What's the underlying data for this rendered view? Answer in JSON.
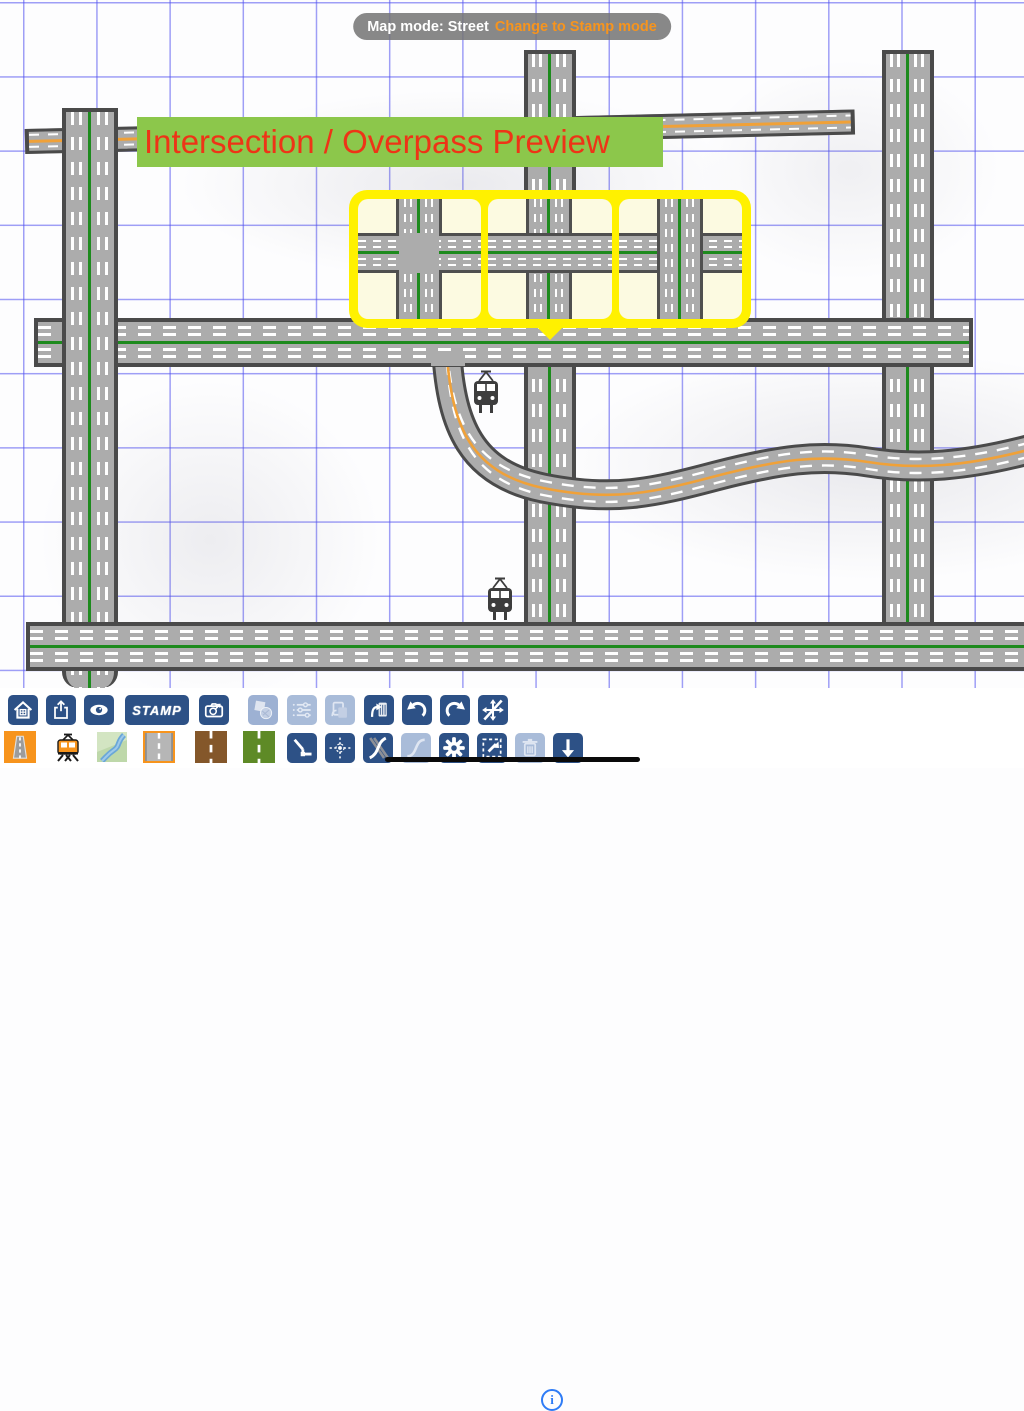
{
  "status_pill": {
    "label": "Map mode: Street",
    "action_label": "Change to Stamp mode"
  },
  "preview_banner": {
    "title": "Intersection / Overpass Preview"
  },
  "preview_popup": {
    "options": [
      {
        "name": "flat-intersection"
      },
      {
        "name": "overpass-horizontal-road-on-top"
      },
      {
        "name": "overpass-vertical-road-on-top"
      }
    ]
  },
  "map": {
    "roads": [
      {
        "name": "top-road-orange-center",
        "orientation": "horizontal"
      },
      {
        "name": "left-avenue-green-center",
        "orientation": "vertical"
      },
      {
        "name": "center-avenue-green-center",
        "orientation": "vertical"
      },
      {
        "name": "right-avenue-green-center",
        "orientation": "vertical"
      },
      {
        "name": "middle-avenue-green-center",
        "orientation": "horizontal"
      },
      {
        "name": "bottom-avenue-green-center",
        "orientation": "horizontal"
      },
      {
        "name": "winding-road-orange-center",
        "orientation": "curved"
      }
    ],
    "markers": [
      {
        "name": "tram-marker-upper"
      },
      {
        "name": "tram-marker-lower"
      }
    ]
  },
  "toolbar": {
    "row1": [
      {
        "name": "home",
        "enabled": true
      },
      {
        "name": "share",
        "enabled": true
      },
      {
        "name": "visibility",
        "enabled": true
      },
      {
        "name": "stamp",
        "label": "STAMP",
        "enabled": true
      },
      {
        "name": "camera",
        "enabled": true
      },
      {
        "name": "shapes",
        "enabled": true
      },
      {
        "name": "layer-settings",
        "enabled": false
      },
      {
        "name": "copy",
        "enabled": false
      },
      {
        "name": "paste",
        "enabled": true
      },
      {
        "name": "undo",
        "enabled": true
      },
      {
        "name": "redo",
        "enabled": true
      },
      {
        "name": "pan-lock",
        "enabled": true
      },
      {
        "name": "info",
        "enabled": true
      }
    ],
    "row2": [
      {
        "name": "road-tool",
        "enabled": true,
        "selected": true
      },
      {
        "name": "rail-tool",
        "enabled": true,
        "selected": false
      },
      {
        "name": "river-tool",
        "enabled": true,
        "selected": false
      },
      {
        "name": "road-style-gray",
        "enabled": true,
        "selected": true
      },
      {
        "name": "road-style-brown",
        "enabled": true,
        "selected": false
      },
      {
        "name": "road-style-green",
        "enabled": true,
        "selected": false
      },
      {
        "name": "corner-tool",
        "enabled": true
      },
      {
        "name": "center-point-tool",
        "enabled": true
      },
      {
        "name": "crossing-curves-tool",
        "enabled": true
      },
      {
        "name": "curve-tool",
        "enabled": false
      },
      {
        "name": "settings",
        "enabled": true
      },
      {
        "name": "resize",
        "enabled": true
      },
      {
        "name": "delete",
        "enabled": false
      },
      {
        "name": "download",
        "enabled": true
      }
    ]
  },
  "info_icon_label": "i",
  "colors": {
    "toolbar_button": "#2d5186",
    "toolbar_button_disabled": "#a9bcd9",
    "selected_outline": "#f7941d",
    "banner_bg": "#8cc74b",
    "banner_text": "#ee3417",
    "popup_border": "#fff100",
    "road_fill": "#acacac",
    "road_edge": "#4a4a4a",
    "center_line_green": "#1d8a1d",
    "center_line_orange": "#f0a138",
    "grid": "#5050f0",
    "info_accent": "#2f7cf6",
    "home_indicator": "#0a0a0a"
  }
}
